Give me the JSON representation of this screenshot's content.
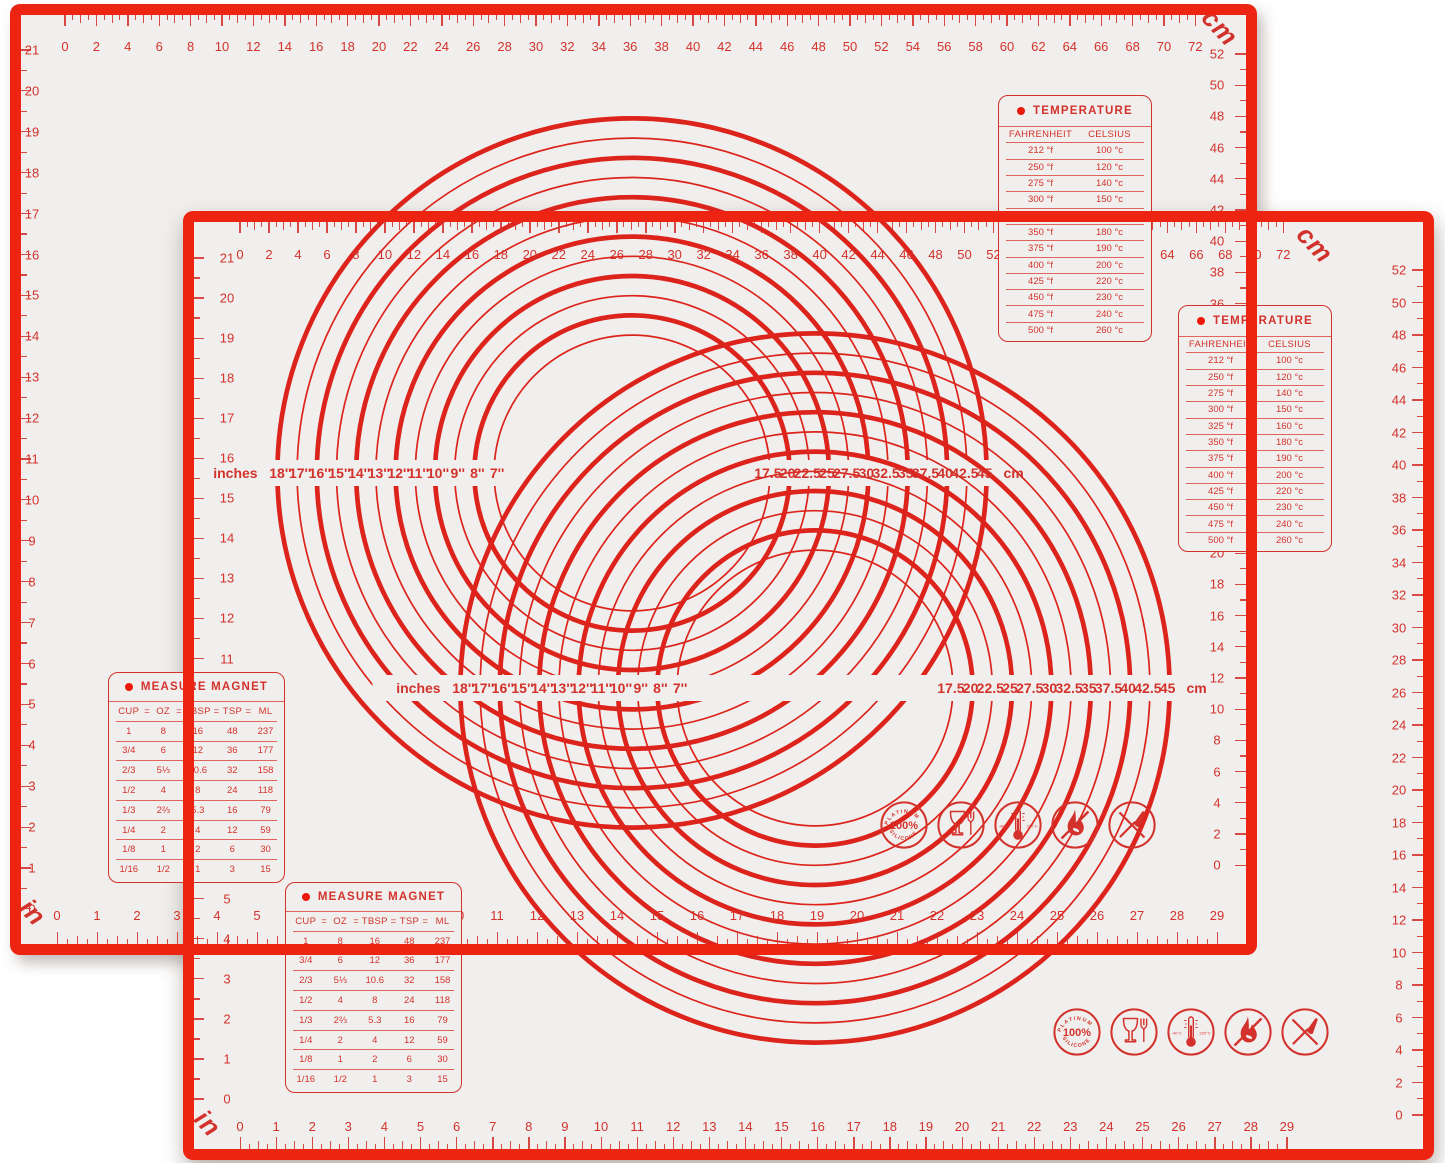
{
  "colors": {
    "border_red": "#ee2412",
    "marking_red": "#d3322c",
    "circle_red": "#dc241c",
    "mat_surface": "#f1efed",
    "page_bg": "#ffffff"
  },
  "mat": {
    "unit_labels": {
      "metric": "cm",
      "imperial": "in"
    },
    "rulers": {
      "top_cm": [
        0,
        2,
        4,
        6,
        8,
        10,
        12,
        14,
        16,
        18,
        20,
        22,
        24,
        26,
        28,
        30,
        32,
        34,
        36,
        38,
        40,
        42,
        44,
        46,
        48,
        50,
        52,
        54,
        56,
        58,
        60,
        62,
        64,
        66,
        68,
        70,
        72
      ],
      "side_cm": [
        52,
        50,
        48,
        46,
        44,
        42,
        40,
        38,
        36,
        34,
        32,
        30,
        28,
        26,
        24,
        22,
        20,
        18,
        16,
        14,
        12,
        10,
        8,
        6,
        4,
        2,
        0
      ],
      "bottom_in": [
        0,
        1,
        2,
        3,
        4,
        5,
        6,
        7,
        8,
        9,
        10,
        11,
        12,
        13,
        14,
        15,
        16,
        17,
        18,
        19,
        20,
        21,
        22,
        23,
        24,
        25,
        26,
        27,
        28,
        29
      ],
      "side_in": [
        21,
        20,
        19,
        18,
        17,
        16,
        15,
        14,
        13,
        12,
        11,
        10,
        9,
        8,
        7,
        6,
        5,
        4,
        3,
        2,
        1,
        0
      ]
    },
    "circle_guide": {
      "left_caption": "inches",
      "right_caption": "cm",
      "inch_labels": [
        "18''",
        "17''",
        "16''",
        "15''",
        "14''",
        "13''",
        "12''",
        "11''",
        "10''",
        "9''",
        "8''",
        "7''"
      ],
      "cm_labels": [
        "17.5",
        "20",
        "22.5",
        "25",
        "27.5",
        "30",
        "32.5",
        "35",
        "37.5",
        "40",
        "42.5",
        "45"
      ],
      "diameters_in": [
        18,
        17,
        16,
        15,
        14,
        13,
        12,
        11,
        10,
        9,
        8,
        7
      ]
    },
    "temperature_table": {
      "title": "TEMPERATURE",
      "columns": [
        "FAHRENHEIT",
        "CELSIUS"
      ],
      "rows": [
        [
          "212 °f",
          "100 °c"
        ],
        [
          "250 °f",
          "120 °c"
        ],
        [
          "275 °f",
          "140 °c"
        ],
        [
          "300 °f",
          "150 °c"
        ],
        [
          "325 °f",
          "160 °c"
        ],
        [
          "350 °f",
          "180 °c"
        ],
        [
          "375 °f",
          "190 °c"
        ],
        [
          "400 °f",
          "200 °c"
        ],
        [
          "425 °f",
          "220 °c"
        ],
        [
          "450 °f",
          "230 °c"
        ],
        [
          "475 °f",
          "240 °c"
        ],
        [
          "500 °f",
          "260 °c"
        ]
      ]
    },
    "measure_table": {
      "title": "MEASURE MAGNET",
      "columns": [
        "CUP",
        "OZ",
        "TBSP",
        "TSP",
        "ML"
      ],
      "rows": [
        [
          "1",
          "8",
          "16",
          "48",
          "237"
        ],
        [
          "3/4",
          "6",
          "12",
          "36",
          "177"
        ],
        [
          "2/3",
          "5⅓",
          "10.6",
          "32",
          "158"
        ],
        [
          "1/2",
          "4",
          "8",
          "24",
          "118"
        ],
        [
          "1/3",
          "2⅔",
          "5.3",
          "16",
          "79"
        ],
        [
          "1/4",
          "2",
          "4",
          "12",
          "59"
        ],
        [
          "1/8",
          "1",
          "2",
          "6",
          "30"
        ],
        [
          "1/16",
          "1/2",
          "1",
          "3",
          "15"
        ]
      ]
    },
    "icons": [
      {
        "name": "platinum-silicone-badge-icon",
        "arc_top": "PLATINUM",
        "center": "100%",
        "arc_bottom": "SILICONE"
      },
      {
        "name": "food-safe-glass-fork-icon"
      },
      {
        "name": "temperature-range-thermometer-icon",
        "left_text": "-40°C",
        "right_text": "220°C"
      },
      {
        "name": "no-open-flame-icon"
      },
      {
        "name": "no-knife-icon"
      }
    ]
  }
}
